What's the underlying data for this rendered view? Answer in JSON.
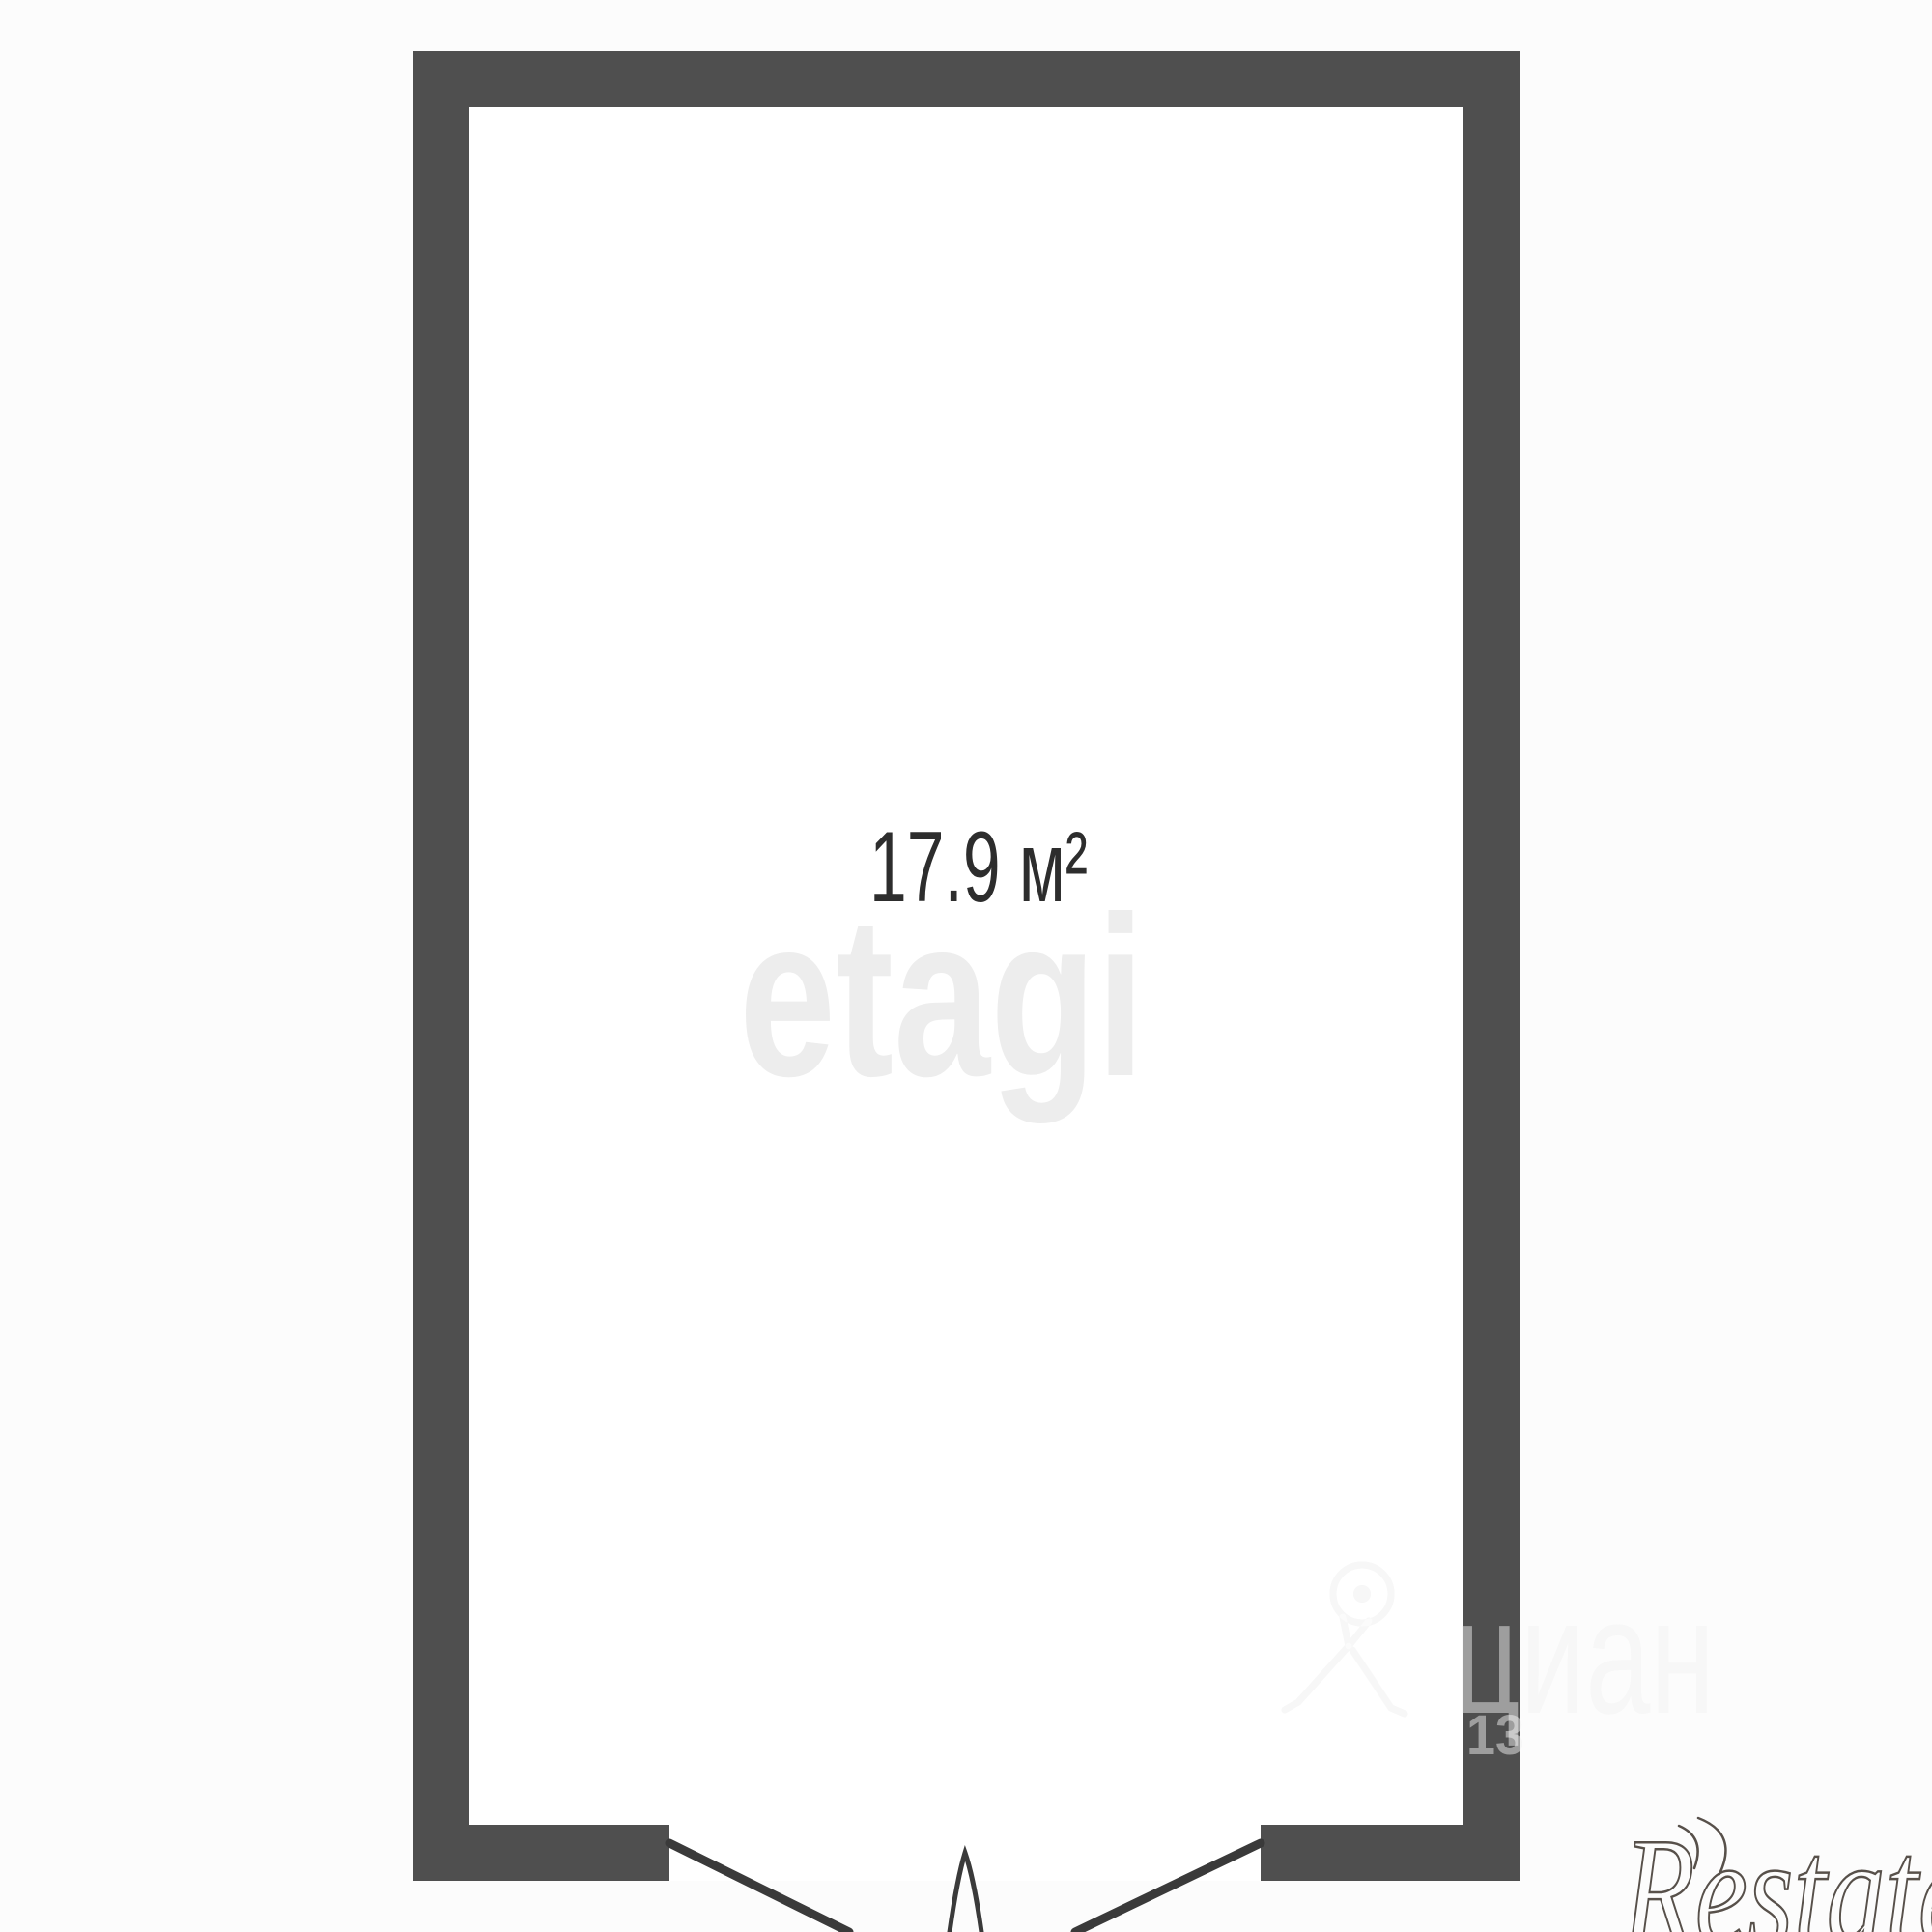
{
  "floorplan": {
    "room": {
      "area_label": "17.9 м²"
    }
  },
  "watermarks": {
    "etagi": "etagi",
    "cian_text": "циан",
    "cian_number": "13",
    "restate": "Restate"
  },
  "colors": {
    "background": "#fcfcfc",
    "room_fill": "#ffffff",
    "wall": "#4f4f4f",
    "area_text": "#2d2d2d",
    "etagi_watermark": "#ededed",
    "cian_watermark_under": "#f0f0f0",
    "cian_watermark_over": "rgba(255,255,255,0.45)",
    "door_line": "#3a3a3a",
    "restate": "#57504a"
  }
}
